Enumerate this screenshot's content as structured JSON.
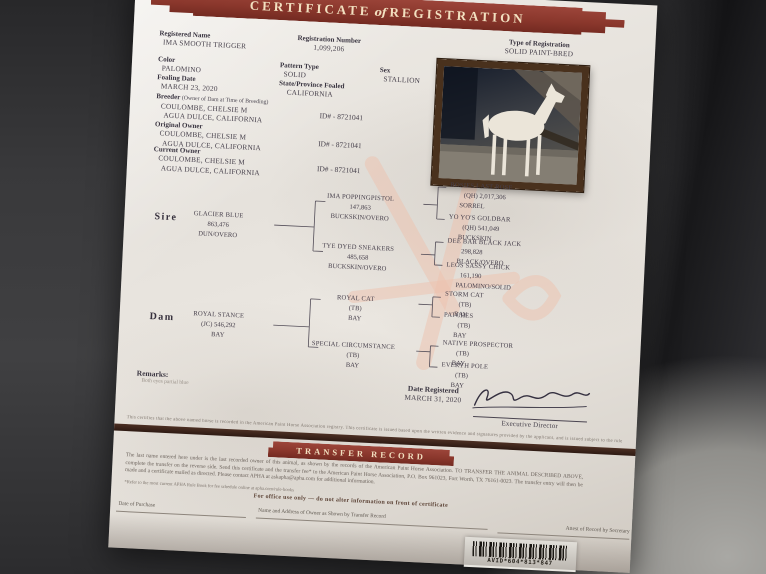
{
  "header": {
    "word1": "CERTIFICATE",
    "of": "of",
    "word2": "REGISTRATION"
  },
  "info": {
    "registered_name": {
      "label": "Registered Name",
      "value": "IMA SMOOTH TRIGGER"
    },
    "registration_number": {
      "label": "Registration Number",
      "value": "1,099,206"
    },
    "type_of_registration": {
      "label": "Type of Registration",
      "value": "SOLID PAINT-BRED"
    },
    "color": {
      "label": "Color",
      "value": "PALOMINO"
    },
    "pattern_type": {
      "label": "Pattern Type",
      "value": "SOLID"
    },
    "sex": {
      "label": "Sex",
      "value": "STALLION"
    },
    "foaling_date": {
      "label": "Foaling Date",
      "value": "MARCH 23, 2020"
    },
    "state_foaled": {
      "label": "State/Province Foaled",
      "value": "CALIFORNIA"
    }
  },
  "owners": [
    {
      "label": "Breeder",
      "note": "(Owner of Dam at Time of Breeding)",
      "name": "COULOMBE, CHELSIE M",
      "address": "AGUA DULCE, CALIFORNIA",
      "id": "ID# - 8721041"
    },
    {
      "label": "Original Owner",
      "note": "",
      "name": "COULOMBE, CHELSIE M",
      "address": "AGUA DULCE, CALIFORNIA",
      "id": "ID# - 8721041"
    },
    {
      "label": "Current Owner",
      "note": "",
      "name": "COULOMBE, CHELSIE M",
      "address": "AGUA DULCE, CALIFORNIA",
      "id": "ID# - 8721041"
    }
  ],
  "pedigree": {
    "sire_label": "Sire",
    "dam_label": "Dam",
    "sire": {
      "name": "GLACIER BLUE",
      "reg": "863,476",
      "color": "DUN/OVERO"
    },
    "dam": {
      "name": "ROYAL STANCE",
      "reg": "(JC)  546,292",
      "color": "BAY"
    },
    "sire_parents": [
      {
        "name": "IMA POPPINGPISTOL",
        "reg": "147,863",
        "color": "BUCKSKIN/OVERO"
      },
      {
        "name": "TYE DYED SNEAKERS",
        "reg": "485,658",
        "color": "BUCKSKIN/OVERO"
      }
    ],
    "dam_parents": [
      {
        "name": "ROYAL CAT",
        "reg": "(TB)",
        "color": "BAY"
      },
      {
        "name": "SPECIAL CIRCUMSTANCE",
        "reg": "(TB)",
        "color": "BAY"
      }
    ],
    "sire_grandparents": [
      {
        "name": "ROSIES LAST ROSE",
        "reg": "(QH) 2,017,306",
        "color": "SORREL"
      },
      {
        "name": "YO YO'S GOLDBAR",
        "reg": "(QH)  541,049",
        "color": "BUCKSKIN"
      },
      {
        "name": "DEE BAR BLACK JACK",
        "reg": "298,828",
        "color": "BLACK/OVERO"
      },
      {
        "name": "LEOS SASSY CHICK",
        "reg": "161,190",
        "color": "PALOMINO/SOLID"
      }
    ],
    "dam_grandparents": [
      {
        "name": "STORM CAT",
        "reg": "(TB)",
        "color": "BAY"
      },
      {
        "name": "PATCHES",
        "reg": "(TB)",
        "color": "BAY"
      },
      {
        "name": "NATIVE PROSPECTOR",
        "reg": "(TB)",
        "color": "BAY"
      },
      {
        "name": "EVERYH POLE",
        "reg": "(TB)",
        "color": "BAY"
      }
    ]
  },
  "remarks": {
    "label": "Remarks:",
    "value": "Both eyes partial blue"
  },
  "registration": {
    "date_label": "Date Registered",
    "date_value": "MARCH 31, 2020",
    "signer_title": "Executive Director"
  },
  "fine_print": "This certifies that the above named horse is recorded in the American Paint Horse Association registry. This certificate is issued based upon the written evidence and signatures provided by the applicant, and is issued subject to the rules of the Association.",
  "transfer": {
    "banner": "TRANSFER RECORD",
    "paragraph": "The last name entered here under is the last recorded owner of this animal, as shown by the records of the American Paint Horse Association. TO TRANSFER THE ANIMAL DESCRIBED ABOVE, complete the transfer on the reverse side. Send this certificate and the transfer fee* to the American Paint Horse Association, P.O. Box 961023, Fort Worth, TX 76161-0023. The transfer entry will then be made and a certificate mailed as directed. Please contact APHA at askapha@apha.com for additional information.",
    "footnote": "*Refer to the most current APHA Rule Book for fee schedule online at apha.com/rule-books",
    "office_line": "For office use only — do not alter information on front of certificate",
    "columns": [
      "Date of Purchase",
      "Name and Address of Owner as Shown by Transfer Record",
      "Attest of Record by Secretary"
    ]
  },
  "barcode_text": "AVID*604*813*847",
  "colors": {
    "banner": "#8a372c",
    "banner_text": "#f2e0c0",
    "watermark": "#edc2ae",
    "photo_frame": "#49311d"
  }
}
